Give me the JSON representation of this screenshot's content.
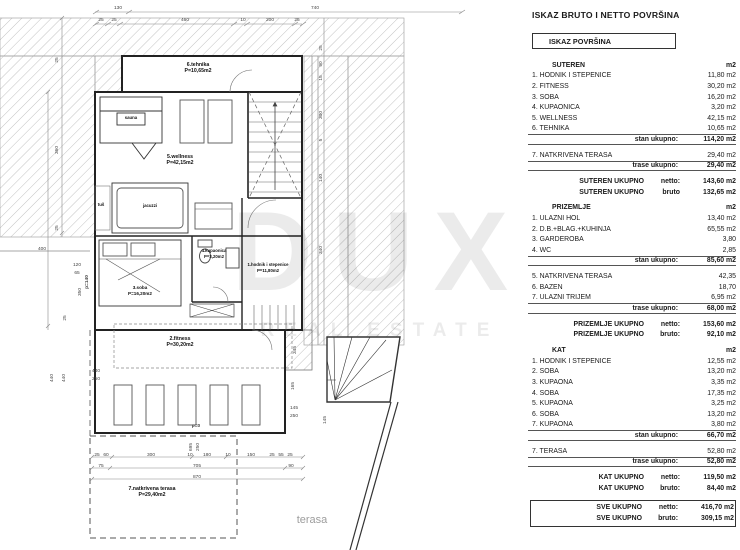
{
  "watermark": {
    "line1": "DUX",
    "line2": "REAL ESTATE"
  },
  "plan": {
    "rooms": [
      {
        "l": [
          "6.tehnika",
          "P=10,65m2"
        ],
        "x": 198,
        "y": 66
      },
      {
        "l": [
          "sauna"
        ],
        "x": 131,
        "y": 119,
        "s": 4.3
      },
      {
        "l": [
          "5.wellness",
          "P=42,15m2"
        ],
        "x": 180,
        "y": 158
      },
      {
        "l": [
          "tuš"
        ],
        "x": 101,
        "y": 206,
        "s": 4.3
      },
      {
        "l": [
          "jacuzzi"
        ],
        "x": 150,
        "y": 207,
        "s": 4.3
      },
      {
        "l": [
          "4.kupaonica",
          "P=3,20m2"
        ],
        "x": 214,
        "y": 252,
        "s": 4.3
      },
      {
        "l": [
          "1.hodnik i stepenice",
          "P=11,80m2"
        ],
        "x": 268,
        "y": 266,
        "s": 4.3
      },
      {
        "l": [
          "3.soba",
          "P=16,20m2"
        ],
        "x": 140,
        "y": 289,
        "s": 4.6
      },
      {
        "l": [
          "2.fitness",
          "P=30,20m2"
        ],
        "x": 180,
        "y": 340
      },
      {
        "l": [
          "7.natkrivena terasa",
          "P=29,40m2"
        ],
        "x": 152,
        "y": 490
      },
      {
        "l": [
          "terasa"
        ],
        "x": 312,
        "y": 523,
        "s": 11,
        "c": "#9d9d9d",
        "w": "normal"
      }
    ],
    "dims": [
      {
        "t": "130",
        "x": 118,
        "y": 9
      },
      {
        "t": "740",
        "x": 315,
        "y": 9
      },
      {
        "t": "25",
        "x": 101,
        "y": 21
      },
      {
        "t": "25",
        "x": 114,
        "y": 21
      },
      {
        "t": "460",
        "x": 185,
        "y": 21
      },
      {
        "t": "10",
        "x": 243,
        "y": 21
      },
      {
        "t": "200",
        "x": 270,
        "y": 21
      },
      {
        "t": "25",
        "x": 297,
        "y": 21
      },
      {
        "t": "400",
        "x": 42,
        "y": 250
      },
      {
        "t": "120",
        "x": 77,
        "y": 266
      },
      {
        "t": "65",
        "x": 77,
        "y": 274
      },
      {
        "t": "25",
        "x": 58,
        "y": 60,
        "r": 1
      },
      {
        "t": "360",
        "x": 58,
        "y": 150,
        "r": 1
      },
      {
        "t": "25",
        "x": 58,
        "y": 228,
        "r": 1
      },
      {
        "t": "350",
        "x": 81,
        "y": 292,
        "r": 1
      },
      {
        "t": "25",
        "x": 66,
        "y": 318,
        "r": 1
      },
      {
        "t": "440",
        "x": 53,
        "y": 378,
        "r": 1
      },
      {
        "t": "440",
        "x": 65,
        "y": 378,
        "r": 1
      },
      {
        "t": "p=140",
        "x": 88,
        "y": 282,
        "r": 1,
        "b": 1
      },
      {
        "t": "440",
        "x": 96,
        "y": 372
      },
      {
        "t": "250",
        "x": 96,
        "y": 380
      },
      {
        "t": "p=0",
        "x": 196,
        "y": 427,
        "b": 1
      },
      {
        "t": "695",
        "x": 192,
        "y": 447,
        "r": 1
      },
      {
        "t": "250",
        "x": 199,
        "y": 447,
        "r": 1
      },
      {
        "t": "145",
        "x": 294,
        "y": 409
      },
      {
        "t": "250",
        "x": 294,
        "y": 417
      },
      {
        "t": "145",
        "x": 326,
        "y": 420,
        "r": 1
      },
      {
        "t": "345",
        "x": 296,
        "y": 350,
        "r": 1
      },
      {
        "t": "165",
        "x": 294,
        "y": 386,
        "r": 1
      },
      {
        "t": "25",
        "x": 322,
        "y": 48,
        "r": 1
      },
      {
        "t": "90",
        "x": 322,
        "y": 64,
        "r": 1
      },
      {
        "t": "15",
        "x": 322,
        "y": 78,
        "r": 1
      },
      {
        "t": "300",
        "x": 322,
        "y": 115,
        "r": 1
      },
      {
        "t": "5",
        "x": 322,
        "y": 140,
        "r": 1
      },
      {
        "t": "140",
        "x": 322,
        "y": 178,
        "r": 1
      },
      {
        "t": "340",
        "x": 322,
        "y": 250,
        "r": 1
      },
      {
        "t": "25",
        "x": 97,
        "y": 456
      },
      {
        "t": "60",
        "x": 106,
        "y": 456
      },
      {
        "t": "300",
        "x": 151,
        "y": 456
      },
      {
        "t": "10",
        "x": 190,
        "y": 456
      },
      {
        "t": "180",
        "x": 207,
        "y": 456
      },
      {
        "t": "10",
        "x": 228,
        "y": 456
      },
      {
        "t": "150",
        "x": 251,
        "y": 456
      },
      {
        "t": "25",
        "x": 272,
        "y": 456
      },
      {
        "t": "55",
        "x": 281,
        "y": 456
      },
      {
        "t": "25",
        "x": 290,
        "y": 456
      },
      {
        "t": "75",
        "x": 101,
        "y": 467
      },
      {
        "t": "705",
        "x": 197,
        "y": 467
      },
      {
        "t": "90",
        "x": 291,
        "y": 467
      },
      {
        "t": "870",
        "x": 197,
        "y": 478
      }
    ]
  },
  "table": {
    "title": "ISKAZ BRUTO I NETTO POVRŠINA",
    "box_header": "ISKAZ POVRŠINA",
    "rows": [
      {
        "type": "section",
        "label": "SUTEREN",
        "value": "m2"
      },
      {
        "type": "item",
        "label": "1. HODNIK I STEPENICE",
        "value": "11,80 m2"
      },
      {
        "type": "item",
        "label": "2. FITNESS",
        "value": "30,20 m2"
      },
      {
        "type": "item",
        "label": "3. SOBA",
        "value": "16,20 m2"
      },
      {
        "type": "item",
        "label": "4. KUPAONICA",
        "value": "3,20 m2"
      },
      {
        "type": "item",
        "label": "5. WELLNESS",
        "value": "42,15 m2"
      },
      {
        "type": "item",
        "label": "6. TEHNIKA",
        "value": "10,65 m2"
      },
      {
        "type": "total",
        "label": "stan ukupno:",
        "value": "114,20  m2"
      },
      {
        "type": "gap"
      },
      {
        "type": "item",
        "label": "7. NATKRIVENA TERASA",
        "value": "29,40 m2"
      },
      {
        "type": "total",
        "label": "trase ukupno:",
        "value": "29,40  m2"
      },
      {
        "type": "gap"
      },
      {
        "type": "grand",
        "label": "SUTEREN  UKUPNO",
        "sub": "netto:",
        "value": "143,60 m2"
      },
      {
        "type": "grand",
        "label": "SUTEREN  UKUPNO",
        "sub": "bruto",
        "value": "132,65 m2"
      },
      {
        "type": "gap"
      },
      {
        "type": "section",
        "label": "PRIZEMLJE",
        "value": "m2"
      },
      {
        "type": "item",
        "label": "1. ULAZNI HOL",
        "value": "13,40 m2"
      },
      {
        "type": "item",
        "label": "2. D.B.+BLAG.+KUHINJA",
        "value": "65,55 m2"
      },
      {
        "type": "item",
        "label": "3. GARDEROBA",
        "value": "3,80"
      },
      {
        "type": "item",
        "label": "4. WC",
        "value": "2,85"
      },
      {
        "type": "total",
        "label": "stan ukupno:",
        "value": "85,60  m2"
      },
      {
        "type": "gap"
      },
      {
        "type": "item",
        "label": "5. NATKRIVENA TERASA",
        "value": "42,35"
      },
      {
        "type": "item",
        "label": "6. BAZEN",
        "value": "18,70"
      },
      {
        "type": "item",
        "label": "7. ULAZNI TRIJEM",
        "value": "6,95 m2"
      },
      {
        "type": "total",
        "label": "trase ukupno:",
        "value": "68,00  m2"
      },
      {
        "type": "gap"
      },
      {
        "type": "grand",
        "label": "PRIZEMLJE UKUPNO",
        "sub": "netto:",
        "value": "153,60 m2"
      },
      {
        "type": "grand",
        "label": "PRIZEMLJE UKUPNO",
        "sub": "bruto:",
        "value": "92,10 m2"
      },
      {
        "type": "gap"
      },
      {
        "type": "section",
        "label": "KAT",
        "value": "m2"
      },
      {
        "type": "item",
        "label": "1. HODNIK I STEPENICE",
        "value": "12,55 m2"
      },
      {
        "type": "item",
        "label": "2. SOBA",
        "value": "13,20 m2"
      },
      {
        "type": "item",
        "label": "3. KUPAONA",
        "value": "3,35 m2"
      },
      {
        "type": "item",
        "label": "4. SOBA",
        "value": "17,35 m2"
      },
      {
        "type": "item",
        "label": "5. KUPAONA",
        "value": "3,25 m2"
      },
      {
        "type": "item",
        "label": "6. SOBA",
        "value": "13,20 m2"
      },
      {
        "type": "item",
        "label": "7. KUPAONA",
        "value": "3,80 m2"
      },
      {
        "type": "total",
        "label": "stan ukupno:",
        "value": "66,70  m2"
      },
      {
        "type": "gap"
      },
      {
        "type": "item",
        "label": "7. TERASA",
        "value": "52,80 m2"
      },
      {
        "type": "total",
        "label": "trase ukupno:",
        "value": "52,80  m2"
      },
      {
        "type": "gap"
      },
      {
        "type": "grand",
        "label": "KAT UKUPNO",
        "sub": "netto:",
        "value": "119,50 m2"
      },
      {
        "type": "grand",
        "label": "KAT UKUPNO",
        "sub": "bruto:",
        "value": "84,40 m2"
      },
      {
        "type": "gap"
      },
      {
        "type": "grand",
        "label": "SVE UKUPNO",
        "sub": "netto:",
        "value": "416,70 m2",
        "box": true
      },
      {
        "type": "grand",
        "label": "SVE UKUPNO",
        "sub": "bruto:",
        "value": "309,15 m2",
        "box": true
      }
    ]
  }
}
